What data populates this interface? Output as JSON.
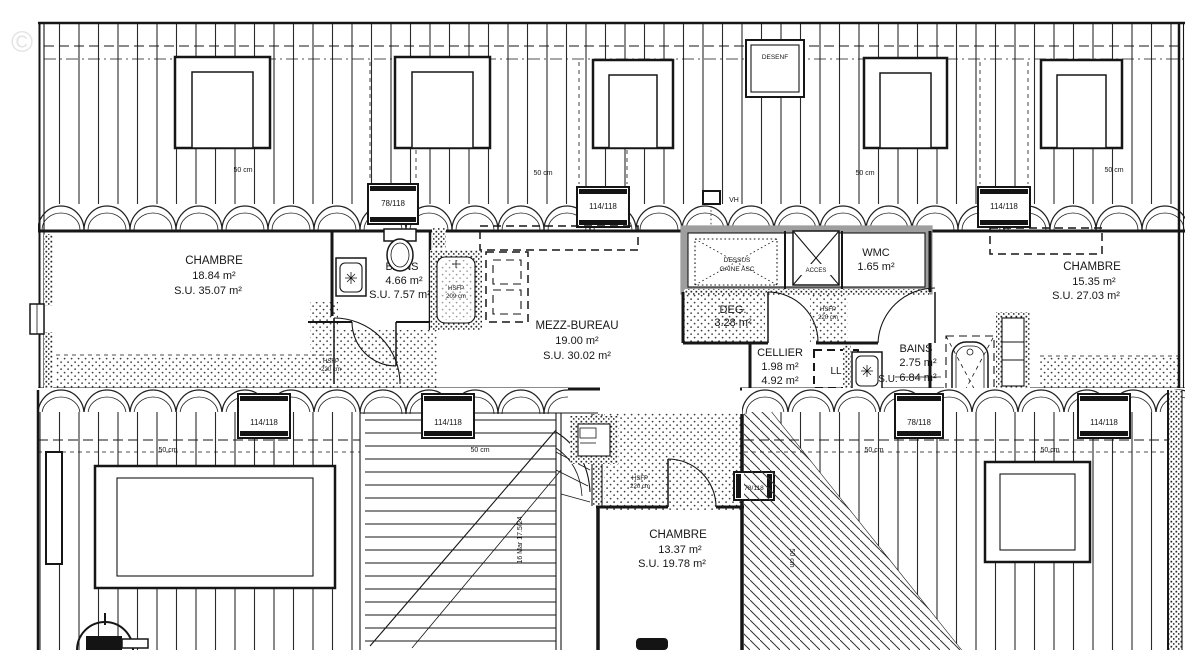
{
  "watermark": "©",
  "rooms": {
    "chambre_left": {
      "name": "CHAMBRE",
      "area": "18.84 m²",
      "su": "S.U. 35.07 m²"
    },
    "bains_left": {
      "name": "BAINS",
      "area": "4.66 m²",
      "su": "S.U. 7.57 m²"
    },
    "mezz_bureau": {
      "name": "MEZZ-BUREAU",
      "area": "19.00 m²",
      "su": "S.U. 30.02 m²"
    },
    "wmc": {
      "name": "WMC",
      "area": "1.65 m²"
    },
    "chambre_right": {
      "name": "CHAMBRE",
      "area": "15.35 m²",
      "su": "S.U. 27.03 m²"
    },
    "deg": {
      "name": "DEG.",
      "area": "3.28 m²"
    },
    "cellier": {
      "name": "CELLIER",
      "area": "1.98 m²",
      "su": "4.92 m²"
    },
    "bains_right": {
      "name": "BAINS",
      "area": "2.75 m²",
      "su": "6.84 m²",
      "su_label": "S.U."
    },
    "chambre_bottom": {
      "name": "CHAMBRE",
      "area": "13.37 m²",
      "su": "S.U. 19.78 m²"
    }
  },
  "features": {
    "desenf": "DESENF",
    "dessus_gaine_line1": "DESSUS",
    "dessus_gaine_line2": "GAINE ASC",
    "acces": "ACCES",
    "vh": "VH",
    "ll": "LL"
  },
  "windows": {
    "w78": "78/118",
    "w114": "114/118"
  },
  "dimensions": {
    "d50": "50 cm"
  },
  "heights": {
    "hsfp": "HSFP",
    "h209": "209 cm",
    "h220": "220 cm"
  },
  "stairs": {
    "note": "16 Mar 17.5/24"
  }
}
